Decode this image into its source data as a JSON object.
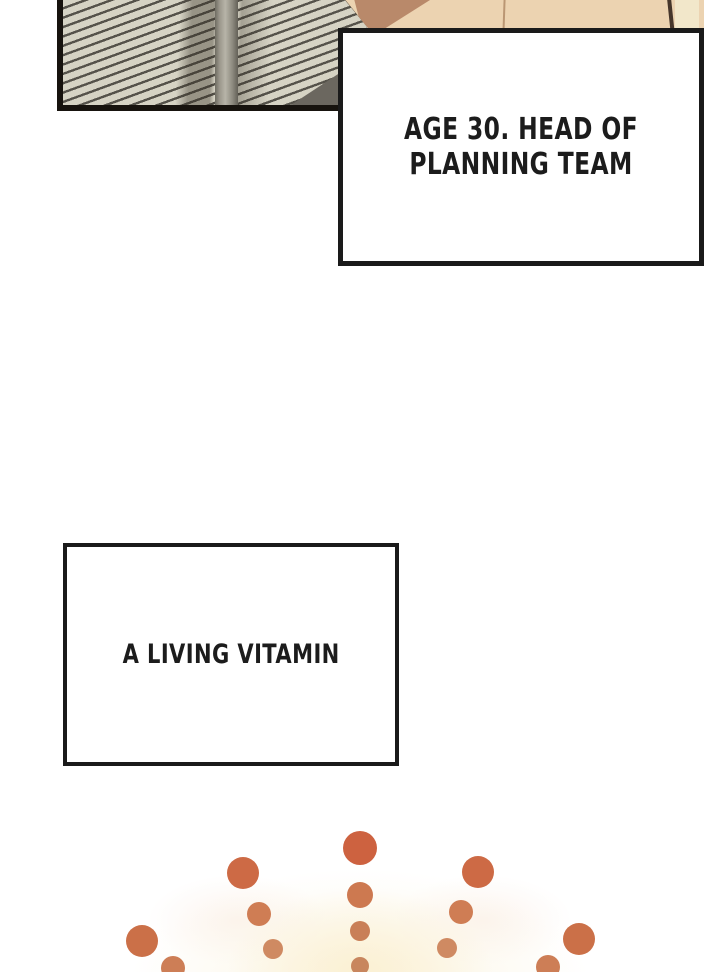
{
  "page": {
    "width": 720,
    "height": 972,
    "background": "#ffffff",
    "kind": "comic-panel-page"
  },
  "window_panel": {
    "slat_color": "#d6d3c4",
    "slat_line_color": "#55524a",
    "frame_divider_color": "#9b978c",
    "border_color": "#17130e",
    "silhouette_color": "#6b675f"
  },
  "figure": {
    "skin_color": "#ecd3b1",
    "skin_shadow_color": "#b9896a",
    "outline_color": "#17130e",
    "seam_color": "#c4a37f",
    "hair_line_color": "#46362b",
    "collar_color": "#f2e7ca"
  },
  "captions": [
    {
      "id": "caption-1",
      "lines": [
        "AGE 30. HEAD OF",
        "PLANNING TEAM"
      ],
      "border_color": "#1a1a1a",
      "text_color": "#1c1c1c"
    },
    {
      "id": "caption-2",
      "lines": [
        "A LIVING VITAMIN"
      ],
      "border_color": "#1a1a1a",
      "text_color": "#1c1c1c"
    }
  ],
  "burst": {
    "glow_color": "#faf0d4",
    "dot_accent_color": "#cd6240",
    "dots": [
      {
        "x": 360,
        "y": 848,
        "r": 17,
        "c": "#cd6240"
      },
      {
        "x": 360,
        "y": 895,
        "r": 13,
        "c": "#cd7950"
      },
      {
        "x": 360,
        "y": 931,
        "r": 10,
        "c": "#c97f57"
      },
      {
        "x": 360,
        "y": 966,
        "r": 9,
        "c": "#c8865e"
      },
      {
        "x": 243,
        "y": 873,
        "r": 16,
        "c": "#cd6a45"
      },
      {
        "x": 259,
        "y": 914,
        "r": 12,
        "c": "#cf7d54"
      },
      {
        "x": 273,
        "y": 949,
        "r": 10,
        "c": "#cf8a62"
      },
      {
        "x": 478,
        "y": 872,
        "r": 16,
        "c": "#cd6a45"
      },
      {
        "x": 461,
        "y": 912,
        "r": 12,
        "c": "#cf7d54"
      },
      {
        "x": 447,
        "y": 948,
        "r": 10,
        "c": "#cf8a62"
      },
      {
        "x": 142,
        "y": 941,
        "r": 16,
        "c": "#cb7048"
      },
      {
        "x": 173,
        "y": 968,
        "r": 12,
        "c": "#cd7e56"
      },
      {
        "x": 579,
        "y": 939,
        "r": 16,
        "c": "#cb7048"
      },
      {
        "x": 548,
        "y": 967,
        "r": 12,
        "c": "#cd7e56"
      }
    ]
  }
}
